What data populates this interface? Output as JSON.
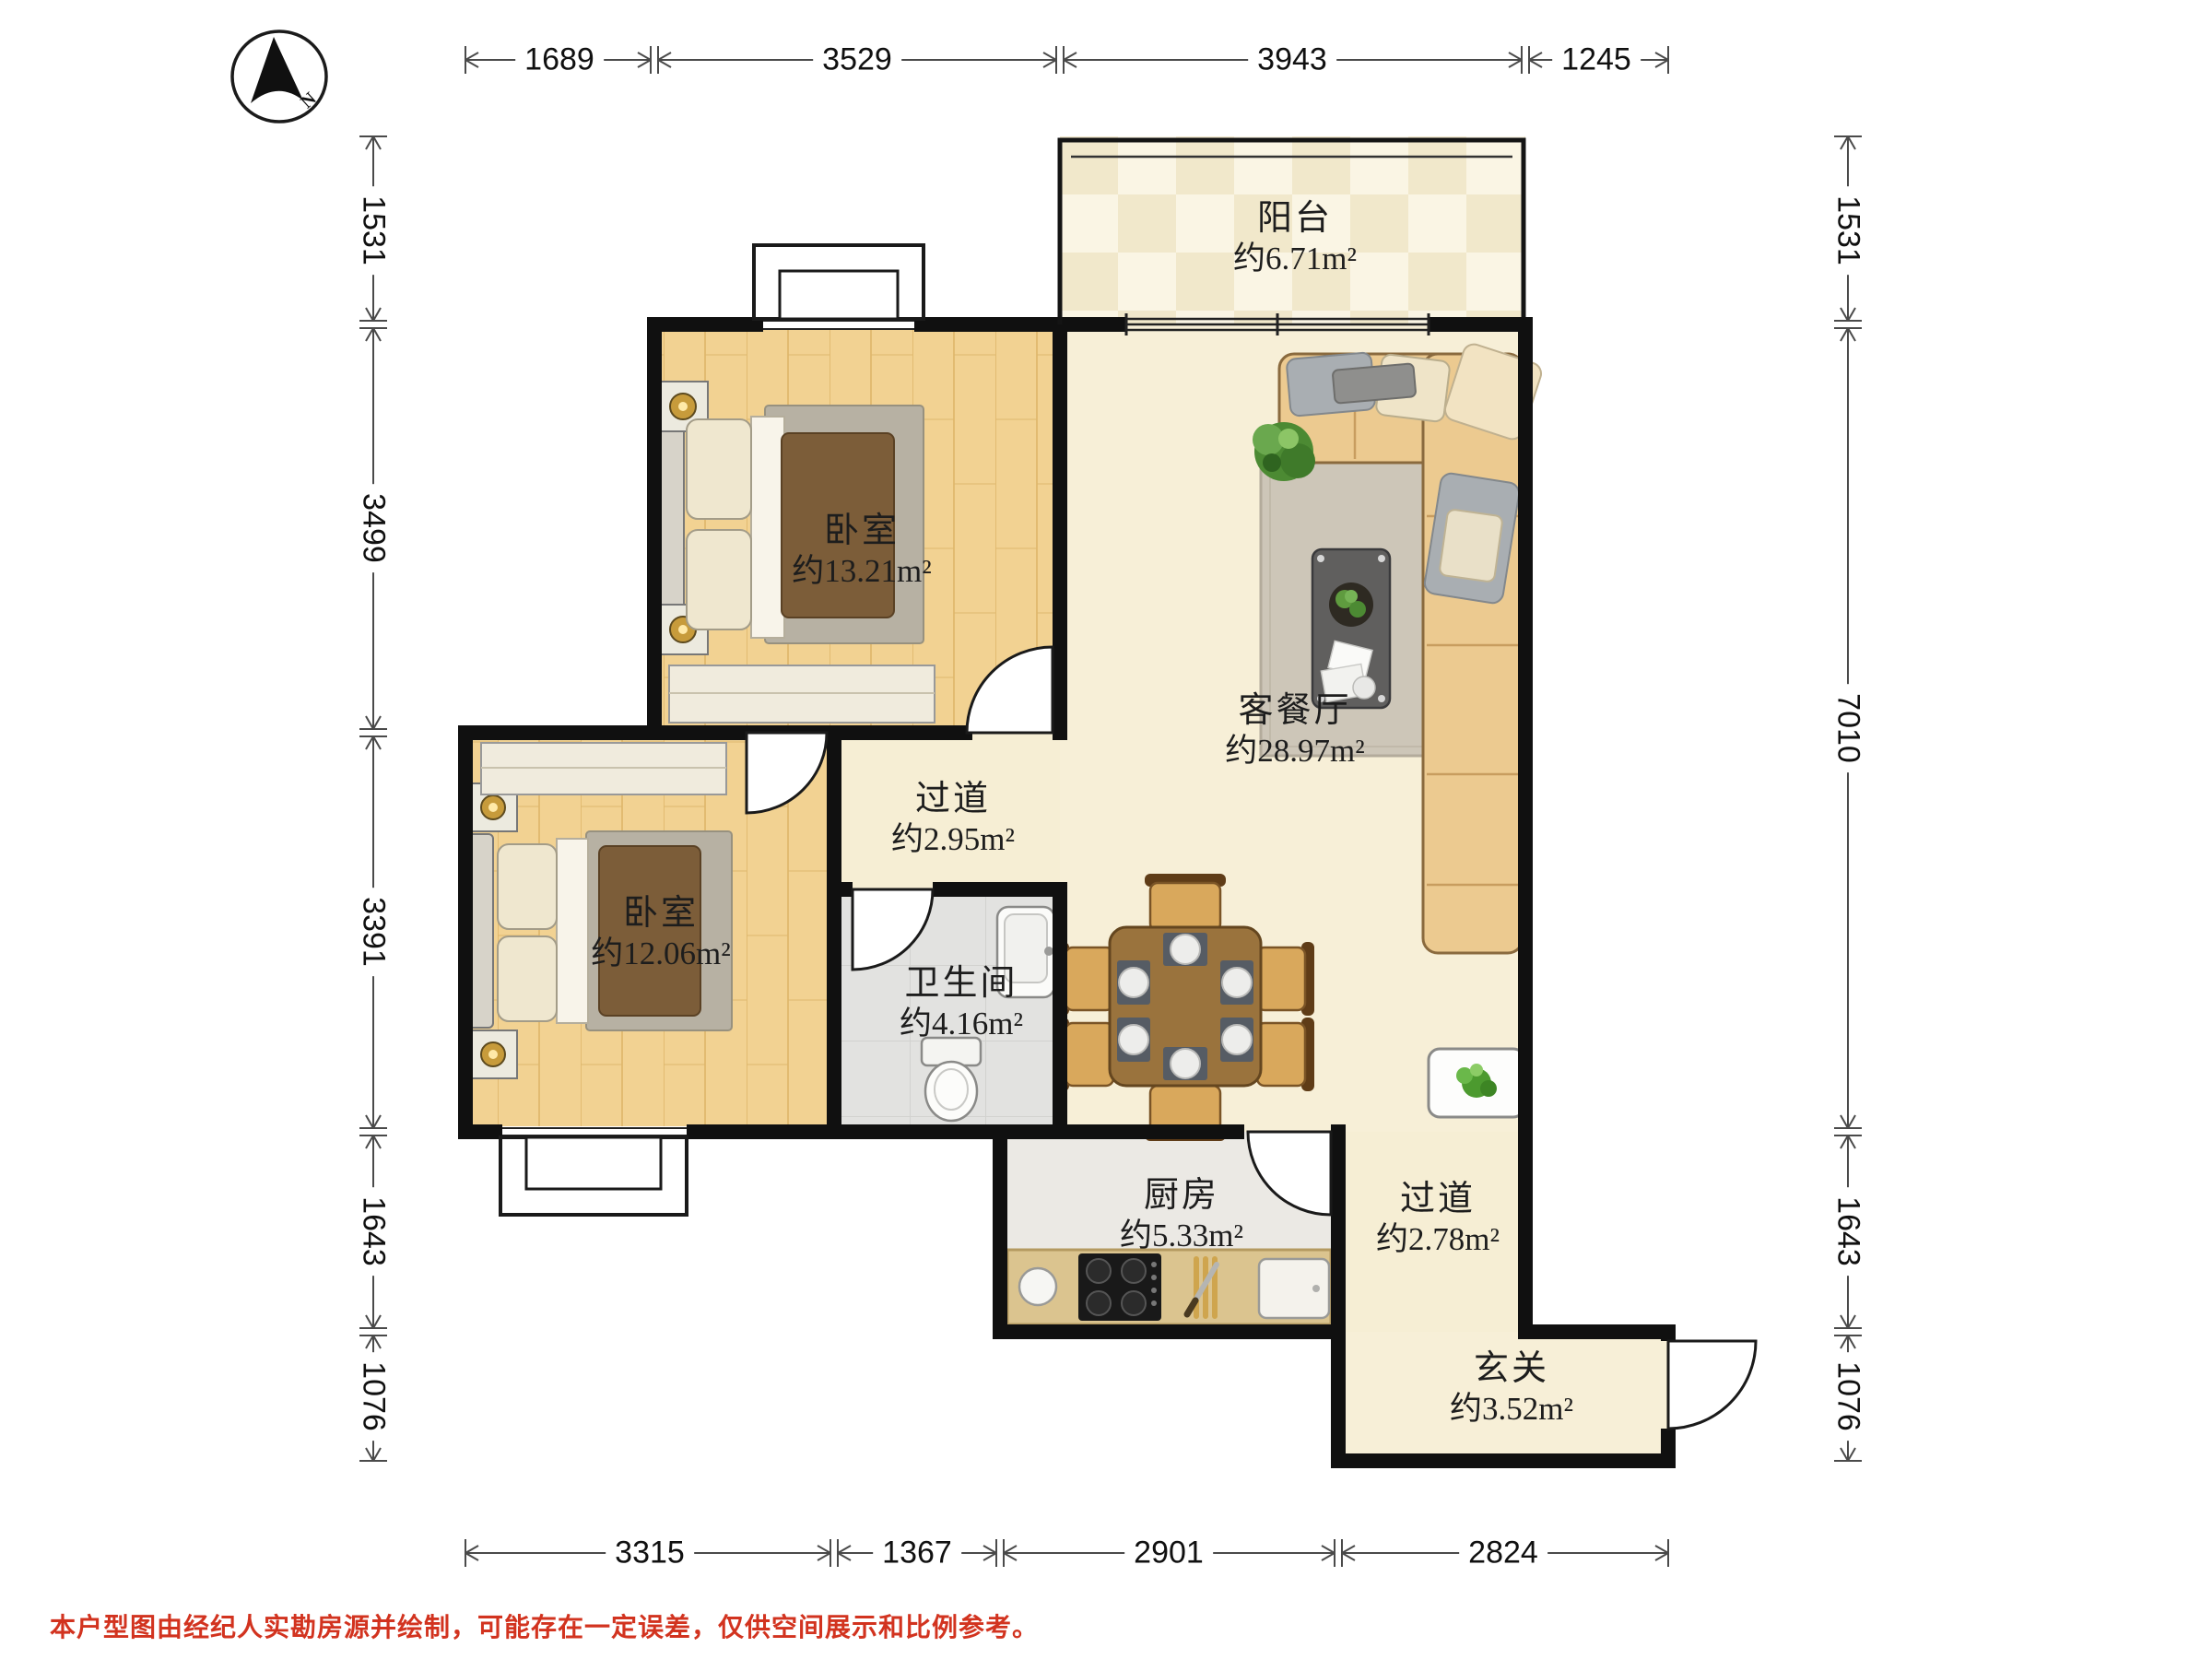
{
  "compass": {
    "north_label": "N"
  },
  "dimensions_mm": {
    "top": [
      "1689",
      "3529",
      "3943",
      "1245"
    ],
    "left": [
      "1531",
      "3499",
      "3391",
      "1643",
      "1076"
    ],
    "right": [
      "1531",
      "7010",
      "1643",
      "1076"
    ],
    "bottom": [
      "3315",
      "1367",
      "2901",
      "2824"
    ]
  },
  "rooms": [
    {
      "name": "阳台",
      "area": "约6.71m²"
    },
    {
      "name": "卧室",
      "area": "约13.21m²"
    },
    {
      "name": "客餐厅",
      "area": "约28.97m²"
    },
    {
      "name": "过道",
      "area": "约2.95m²"
    },
    {
      "name": "卧室",
      "area": "约12.06m²"
    },
    {
      "name": "卫生间",
      "area": "约4.16m²"
    },
    {
      "name": "厨房",
      "area": "约5.33m²"
    },
    {
      "name": "过道",
      "area": "约2.78m²"
    },
    {
      "name": "玄关",
      "area": "约3.52m²"
    }
  ],
  "footer": {
    "disclaimer": "本户型图由经纪人实勘房源并绘制，可能存在一定误差，仅供空间展示和比例参考。"
  },
  "colors": {
    "wall": "#101010",
    "wood_floor": "#f2d292",
    "cream_floor": "#f7efd7",
    "balcony_tile": "#f1e8cb",
    "bath_floor": "#e2e2e0",
    "kitchen_floor": "#ebe9e4",
    "counter": "#dbc48f",
    "sofa": "#ecca90",
    "duvet": "#7c5d39",
    "dining_table": "#9a733d",
    "rug": "#cdc6b8",
    "disclaimer_red": "#d2331f"
  }
}
